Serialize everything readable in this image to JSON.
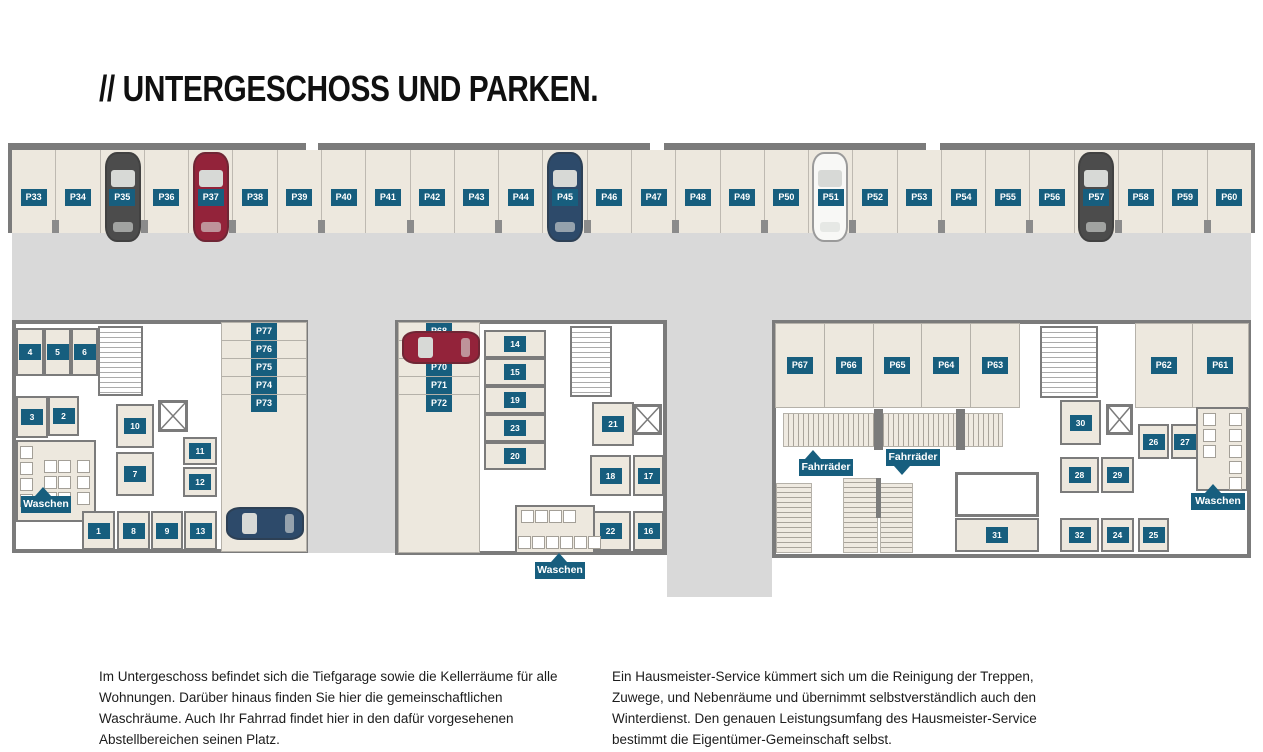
{
  "title": "// UNTERGESCHOSS UND PARKEN.",
  "colors": {
    "accent_teal": "#175E7E",
    "room_beige": "#EDE8DE",
    "driveway_gray": "#D9D9D9",
    "wall_gray": "#7B7B7B",
    "car_dark": "#4C4C4C",
    "car_red": "#93233A",
    "car_blue": "#2D4A6A",
    "car_white": "#F8F8F6"
  },
  "parking": {
    "top_row": [
      "P33",
      "P34",
      "P35",
      "P36",
      "P37",
      "P38",
      "P39",
      "P40",
      "P41",
      "P42",
      "P43",
      "P44",
      "P45",
      "P46",
      "P47",
      "P48",
      "P49",
      "P50",
      "P51",
      "P52",
      "P53",
      "P54",
      "P55",
      "P56",
      "P57",
      "P58",
      "P59",
      "P60"
    ],
    "left_column": [
      "P77",
      "P76",
      "P75",
      "P74",
      "P73"
    ],
    "middle_column": [
      "P68",
      "P69",
      "P70",
      "P71",
      "P72"
    ],
    "right_row": [
      "P67",
      "P66",
      "P65",
      "P64",
      "P63"
    ],
    "right_pair": [
      "P62",
      "P61"
    ],
    "occupied": {
      "top": [
        "P35",
        "P37",
        "P45",
        "P51",
        "P57"
      ],
      "lower": [
        "P73",
        "P68"
      ]
    }
  },
  "rooms": {
    "left": [
      "4",
      "5",
      "6",
      "3",
      "2",
      "10",
      "7",
      "11",
      "12",
      "1",
      "8",
      "9",
      "13"
    ],
    "middle": [
      "14",
      "15",
      "19",
      "23",
      "20",
      "21",
      "18",
      "17",
      "22",
      "16"
    ],
    "right": [
      "31",
      "30",
      "26",
      "27",
      "28",
      "29",
      "32",
      "24",
      "25"
    ]
  },
  "callouts": {
    "waschen": "Waschen",
    "fahrraeder": "Fahrräder"
  },
  "paragraphs": {
    "left": "Im Untergeschoss befindet sich die Tiefgarage sowie die Kellerräume für alle Wohnungen. Darüber hinaus finden Sie hier die gemeinschaftlichen Waschräume. Auch Ihr Fahrrad findet hier in den dafür vorgesehenen Abstellbereichen seinen Platz.",
    "right": "Ein Hausmeister-Service kümmert sich um die Reinigung der Treppen, Zuwege, und Nebenräume und übernimmt selbstverständlich auch den Winterdienst. Den genauen Leistungsumfang des Hausmeister-Service bestimmt die Eigentümer-Gemeinschaft selbst."
  }
}
